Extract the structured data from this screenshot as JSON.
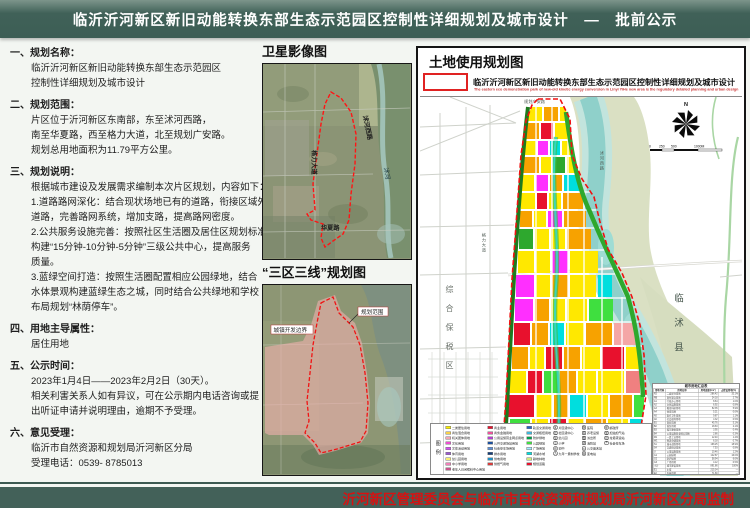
{
  "header": {
    "title": "临沂沂河新区新旧动能转换东部生态示范园区控制性详细规划及城市设计　—　批前公示"
  },
  "sections": [
    {
      "num": "一、",
      "title": "规划名称：",
      "lines": [
        "临沂沂河新区新旧动能转换东部生态示范园区",
        "控制性详细规划及城市设计"
      ]
    },
    {
      "num": "二、",
      "title": "规划范围：",
      "lines": [
        "片区位于沂河新区东南部，东至沭河西路，",
        "南至华夏路，西至格力大道，北至规划广安路。",
        "规划总用地面积为11.79平方公里。"
      ]
    },
    {
      "num": "三、",
      "title": "规划说明：",
      "lines": [
        "根据城市建设及发展需求编制本次片区规划，内容如下：",
        "1.道路路网深化：结合现状场地已有的道路，衔接区域外",
        "道路，完善路网系统，增加支路，提高路网密度。",
        "2.公共服务设施完善：按照社区生活圈及居住区规划标准，",
        "构建“15分钟-10分钟-5分钟”三级公共中心，提高服务",
        "质量。",
        "3.蓝绿空间打造：按照生活圈配置相应公园绿地，结合",
        "水体景观构建蓝绿生态之城，同时结合公共绿地和学校",
        "布局规划“林荫停车”。"
      ]
    },
    {
      "num": "四、",
      "title": "用地主导属性：",
      "lines": [
        "居住用地"
      ]
    },
    {
      "num": "五、",
      "title": "公示时间：",
      "lines": [
        "2023年1月4日——2023年2月2日（30天）。",
        "相关利害关系人如有异议，可在公示期内电话咨询或提",
        "出听证申请并说明理由，逾期不予受理。"
      ]
    },
    {
      "num": "六、",
      "title": "意见受理：",
      "lines": [
        "临沂市自然资源和规划局沂河新区分局",
        "受理电话：0539- 8785013"
      ]
    }
  ],
  "middle": {
    "satellite_title": "卫星影像图",
    "satellite_labels": {
      "west_road": "格力大道",
      "east_road": "沭河西路",
      "south_road": "华夏路",
      "river": "沭河"
    },
    "three_zones_title": "“三区三线”规划图",
    "three_zones_labels": {
      "boundary": "城镇开发边界",
      "scope": "规划范围"
    }
  },
  "landuse": {
    "title": "土地使用规划图",
    "map_title_cn": "临沂沂河新区新旧动能转换东部生态示范园区控制性详细规划及城市设计",
    "map_title_en": "The eastern eco demonstration park of new-old kinetic energy conversion in Linyi YiHe new area is the regulatory detailed planning and urban design",
    "north_label": "N",
    "scale_labels": [
      "0",
      "250",
      "500",
      "1000M"
    ],
    "county_label": "临沭县",
    "bonded_zone_label": "综合保税区",
    "road_labels": {
      "east": "沭河西路",
      "west": "格力大道",
      "south": "华夏路",
      "north": "规划广安路"
    },
    "legend_title": "图例",
    "legend": {
      "columns": [
        {
          "type": "swatch",
          "items": [
            {
              "color": "#fcf000",
              "label": "二类居住用地"
            },
            {
              "color": "#f7d24a",
              "label": "商住混合用地"
            },
            {
              "color": "#f2a6b4",
              "label": "机关团体用地"
            },
            {
              "color": "#f04fd4",
              "label": "文化用地"
            },
            {
              "color": "#d44ff1",
              "label": "文体活动用地"
            },
            {
              "color": "#9b59d0",
              "label": "体育用地"
            },
            {
              "color": "#f9ef70",
              "label": "幼儿园用地"
            },
            {
              "color": "#f080b8",
              "label": "中小学用地"
            },
            {
              "color": "#c9548c",
              "label": "老年人日间照料中心用地"
            }
          ]
        },
        {
          "type": "swatch",
          "items": [
            {
              "color": "#e8112d",
              "label": "商业用地"
            },
            {
              "color": "#ef4f9b",
              "label": "商务金融用地"
            },
            {
              "color": "#b83fd0",
              "label": "公用设施营业网点用地"
            },
            {
              "color": "#1b4f9e",
              "label": "公共交通场站用地"
            },
            {
              "color": "#5b8ed6",
              "label": "社会停车场用地"
            },
            {
              "color": "#123c7a",
              "label": "排水用地"
            },
            {
              "color": "#1f8fc4",
              "label": "供电用地"
            },
            {
              "color": "#d93a3a",
              "label": "供燃气用地"
            }
          ]
        },
        {
          "type": "swatch",
          "items": [
            {
              "color": "#2464c8",
              "label": "轨道交通用地"
            },
            {
              "color": "#3fb6dc",
              "label": "交通枢纽用地"
            },
            {
              "color": "#00a14b",
              "label": "防护绿地"
            },
            {
              "color": "#3fe03f",
              "label": "公园绿地"
            },
            {
              "color": "#a5ebff",
              "label": "广场用地"
            },
            {
              "color": "#00e0e0",
              "label": "河湖水域"
            },
            {
              "color": "#cfe97d",
              "label": "耕地林地"
            },
            {
              "color": "#e8112d",
              "label": "规划道路"
            }
          ]
        },
        {
          "type": "icon",
          "items": [
            {
              "glyph": "区",
              "label": "片区级中心"
            },
            {
              "glyph": "社",
              "label": "社区级中心"
            },
            {
              "glyph": "幼",
              "label": "幼儿园"
            },
            {
              "glyph": "小",
              "label": "小学"
            },
            {
              "glyph": "初",
              "label": "初中"
            },
            {
              "glyph": "九",
              "label": "九年一贯制学校"
            }
          ]
        },
        {
          "type": "icon",
          "items": [
            {
              "glyph": "医",
              "label": "医院"
            },
            {
              "glyph": "养",
              "label": "养老设施"
            },
            {
              "glyph": "警",
              "label": "派出所"
            },
            {
              "glyph": "消",
              "label": "消防站"
            },
            {
              "glyph": "公",
              "label": "公交首末站"
            },
            {
              "glyph": "变",
              "label": "变电站"
            }
          ]
        },
        {
          "type": "icon",
          "items": [
            {
              "glyph": "邮",
              "label": "邮政所"
            },
            {
              "glyph": "加",
              "label": "加油加气站"
            },
            {
              "glyph": "垃",
              "label": "垃圾转运站"
            },
            {
              "glyph": "P",
              "label": "社会停车场"
            }
          ]
        }
      ]
    },
    "table": {
      "title": "城市用地汇总表",
      "headers": [
        "用地代码",
        "用地名称",
        "用地面积(hm²)",
        "占建设用地(%)"
      ],
      "rows": [
        [
          "R2",
          "二类居住用地",
          "286.42",
          "32.1%"
        ],
        [
          "RB",
          "商住混合用地",
          "24.18",
          "2.7%"
        ],
        [
          "A1",
          "行政办公用地",
          "8.64",
          "1.0%"
        ],
        [
          "A2",
          "文化设施用地",
          "6.92",
          "0.8%"
        ],
        [
          "A3",
          "教育科研用地",
          "52.35",
          "5.9%"
        ],
        [
          "A4",
          "体育用地",
          "5.21",
          "0.6%"
        ],
        [
          "A5",
          "医疗卫生用地",
          "9.87",
          "1.1%"
        ],
        [
          "A6",
          "社会福利用地",
          "4.32",
          "0.5%"
        ],
        [
          "B1",
          "商业用地",
          "45.76",
          "5.1%"
        ],
        [
          "B2",
          "商务用地",
          "18.63",
          "2.1%"
        ],
        [
          "B3",
          "娱乐康体用地",
          "3.95",
          "0.4%"
        ],
        [
          "B4",
          "公用设施营业网点用地",
          "2.86",
          "0.3%"
        ],
        [
          "M1",
          "一类工业用地",
          "12.40",
          "1.4%"
        ],
        [
          "W1",
          "物流仓储用地",
          "6.18",
          "0.7%"
        ],
        [
          "S1",
          "城市道路用地",
          "168.25",
          "18.9%"
        ],
        [
          "S4",
          "交通场站用地",
          "7.53",
          "0.8%"
        ],
        [
          "U",
          "公用设施用地",
          "10.46",
          "1.2%"
        ],
        [
          "G1",
          "公园绿地",
          "142.87",
          "16.0%"
        ],
        [
          "G2",
          "防护绿地",
          "58.94",
          "6.6%"
        ],
        [
          "G3",
          "广场用地",
          "4.12",
          "0.5%"
        ],
        [
          "小计",
          "城市建设用地",
          "891.86",
          "100%"
        ],
        [
          "E1",
          "水域",
          "215.34",
          "—"
        ],
        [
          "E2",
          "农林用地",
          "71.80",
          "—"
        ],
        [
          "合计",
          "规划总用地",
          "1179.00",
          "—"
        ]
      ]
    }
  },
  "footer": {
    "credit": "沂河新区管理委员会与临沂市自然资源和规划局沂河新区分局监制"
  }
}
